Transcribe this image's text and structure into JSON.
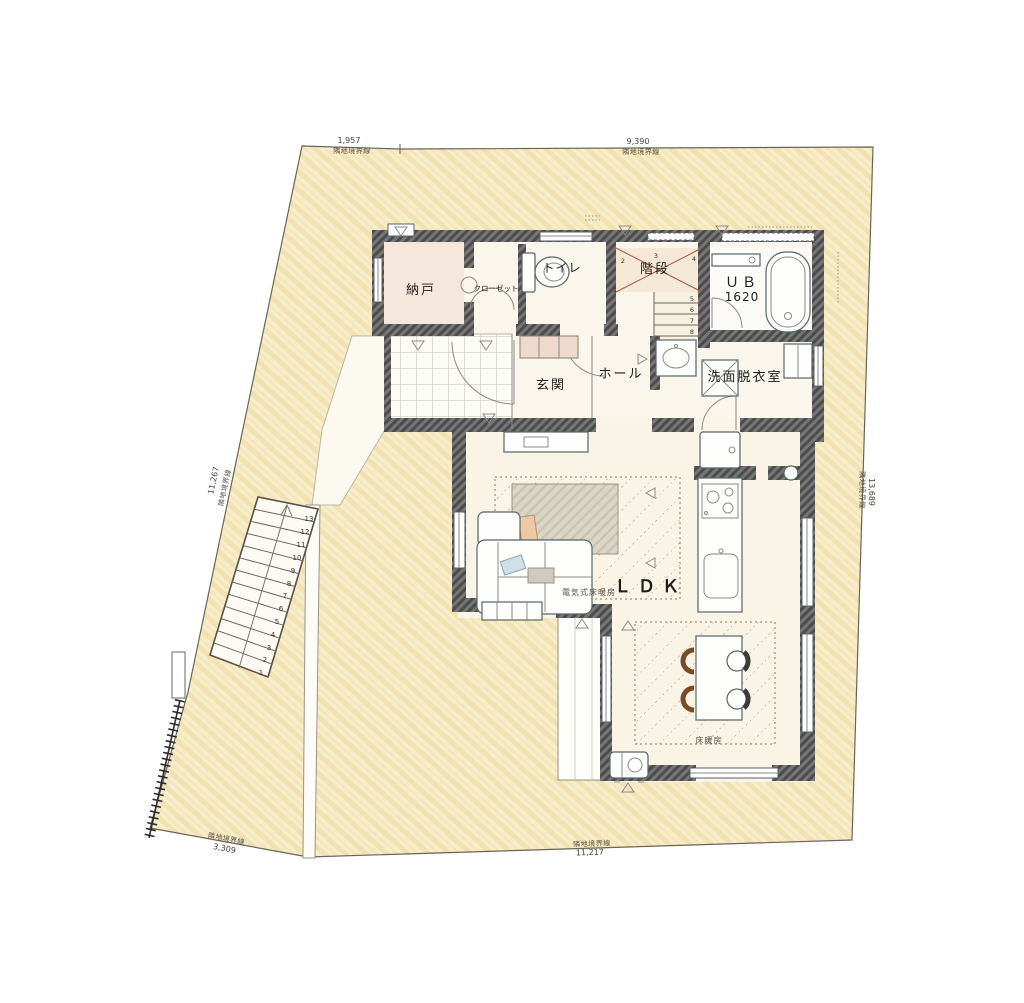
{
  "plan": {
    "type": "floor-plan-site-plan",
    "boundaries": [
      {
        "id": "top-left",
        "label": "隣地境界線",
        "dim": "1,957"
      },
      {
        "id": "top-right",
        "label": "隣地境界線",
        "dim": "9,390"
      },
      {
        "id": "left",
        "label": "隣地境界線",
        "dim": "11,267"
      },
      {
        "id": "right",
        "label": "隣地境界線",
        "dim": "13,689"
      },
      {
        "id": "bottom-left",
        "label": "隣地境界線",
        "dim": "3,309"
      },
      {
        "id": "bottom",
        "label": "隣地境界線",
        "dim": "11,217"
      }
    ],
    "rooms": {
      "storage": "納戸",
      "closet": "クローゼット",
      "toilet": "トイレ",
      "stairs": "階段",
      "bath_line1": "ＵＢ",
      "bath_line2": "1620",
      "entrance": "玄関",
      "hall": "ホール",
      "washroom": "洗面脱衣室",
      "ldk": "ＬＤＫ"
    },
    "annotations": {
      "electric_floor_heating": "電気式床暖房",
      "floor_heating": "床暖房"
    },
    "outdoor_steps": [
      "1",
      "2",
      "3",
      "4",
      "5",
      "6",
      "7",
      "8",
      "9",
      "10",
      "11",
      "12",
      "13"
    ],
    "indoor_steps": {
      "winder": [
        "1",
        "2",
        "3",
        "4"
      ],
      "run": [
        "5",
        "6",
        "7",
        "8"
      ]
    },
    "colors": {
      "site_fill": "#f8edc9",
      "site_hatch": "#eedcab",
      "wall": "#5f5f5f",
      "floor": "#fbf6ec",
      "storage_floor": "#f6e7dd",
      "shoe_cabinet": "#eedacd",
      "stair_floor": "#f5e8d7",
      "rug": "#d9d3c6",
      "heat_line": "#8a7a5a"
    }
  }
}
